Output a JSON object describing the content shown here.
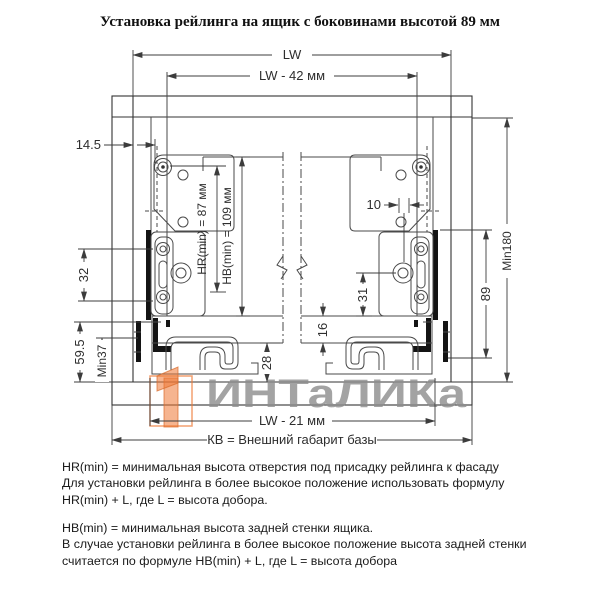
{
  "title": "Установка рейлинга на ящик с боковинами высотой 89 мм",
  "diagram": {
    "dims": {
      "lw": "LW",
      "lw42": "LW - 42 мм",
      "d145": "14.5",
      "d32": "32",
      "d595": "59.5",
      "min37": "Min37",
      "hr": "HR(min) = 87 мм",
      "hb": "HB(min) = 109 мм",
      "d16": "16",
      "d31": "31",
      "d10": "10",
      "d28": "28",
      "d89": "89",
      "min180": "Min180",
      "lw21": "LW - 21 мм",
      "kb": "КВ = Внешний габарит базы"
    },
    "colors": {
      "line": "#3c3c3c",
      "part_black": "#141414"
    }
  },
  "watermark": {
    "text": "ИНТаЛИКа",
    "text_color": "#8d8d8d",
    "logo_color": "#ee7733"
  },
  "notes": {
    "p1": [
      "HR(min) = минимальная высота отверстия под присадку рейлинга к фасаду",
      "Для установки рейлинга в более высокое положение использовать формулу",
      "HR(min) + L,  где L = высота добора."
    ],
    "p2": [
      "HB(min) = минимальная высота задней стенки ящика.",
      "В случае установки рейлинга в более высокое положение высота задней стенки",
      "считается по формуле HB(min) + L, где L = высота добора"
    ]
  }
}
